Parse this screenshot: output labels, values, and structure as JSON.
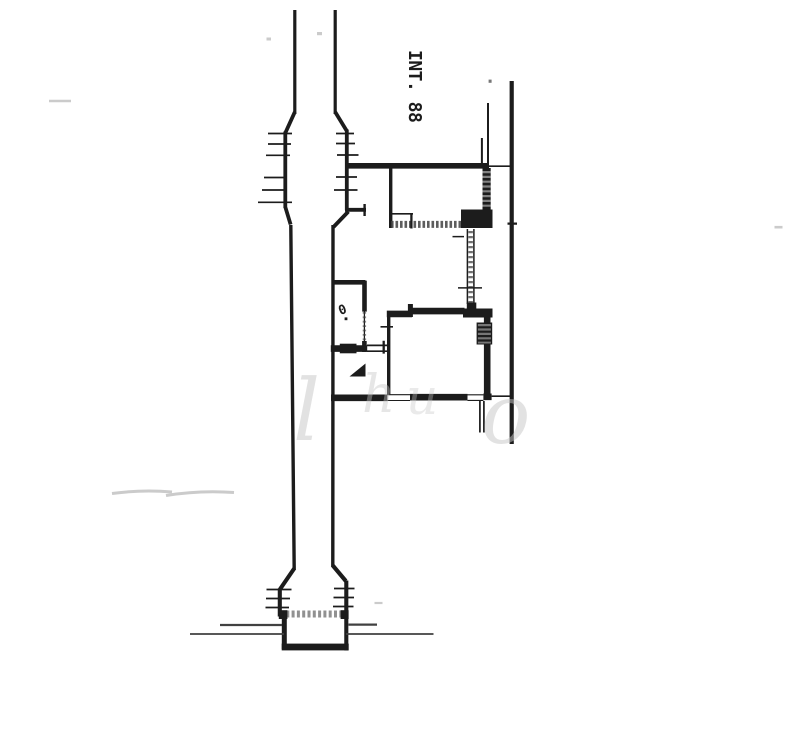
{
  "labels": {
    "unit_number": "INT. 88",
    "room_mark": "0"
  },
  "watermark": {
    "glyphs": [
      "l",
      "h",
      "u",
      "o"
    ]
  },
  "colors": {
    "paper": "#ffffff",
    "ink": "#1c1c1c",
    "ink_soft": "#414141",
    "hatch": "#919191",
    "watermark": "#c6c6c6",
    "artifact": "#cbcbcb"
  }
}
